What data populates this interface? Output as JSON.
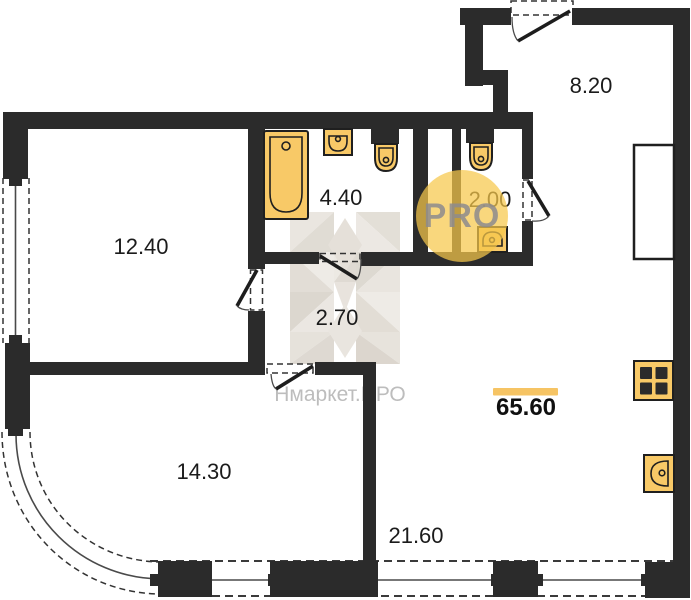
{
  "plan": {
    "badge_text": "PRO",
    "brand_watermark": "Нмаркет.ПРО",
    "total_area_label": "65.60",
    "rooms": [
      {
        "name": "entry-hall",
        "area_label": "8.20"
      },
      {
        "name": "wc",
        "area_label": "2.00"
      },
      {
        "name": "bathroom",
        "area_label": "4.40"
      },
      {
        "name": "bedroom",
        "area_label": "12.40"
      },
      {
        "name": "inner-hall",
        "area_label": "2.70"
      },
      {
        "name": "room",
        "area_label": "14.30"
      },
      {
        "name": "kitchen-living-room",
        "area_label": "21.60"
      }
    ],
    "fixtures": [
      "bathtub",
      "washbasin",
      "toilet",
      "toilet",
      "washbasin",
      "wardrobe",
      "stove",
      "kitchen-sink"
    ],
    "colors": {
      "wall": "#2b2b2b",
      "fixture_fill": "#F8C967",
      "accent": "#F6C464",
      "badge_bg": "#F6C74B",
      "badge_text_color": "#8E8C8E",
      "watermark_text_color": "#BDBDBD"
    }
  }
}
